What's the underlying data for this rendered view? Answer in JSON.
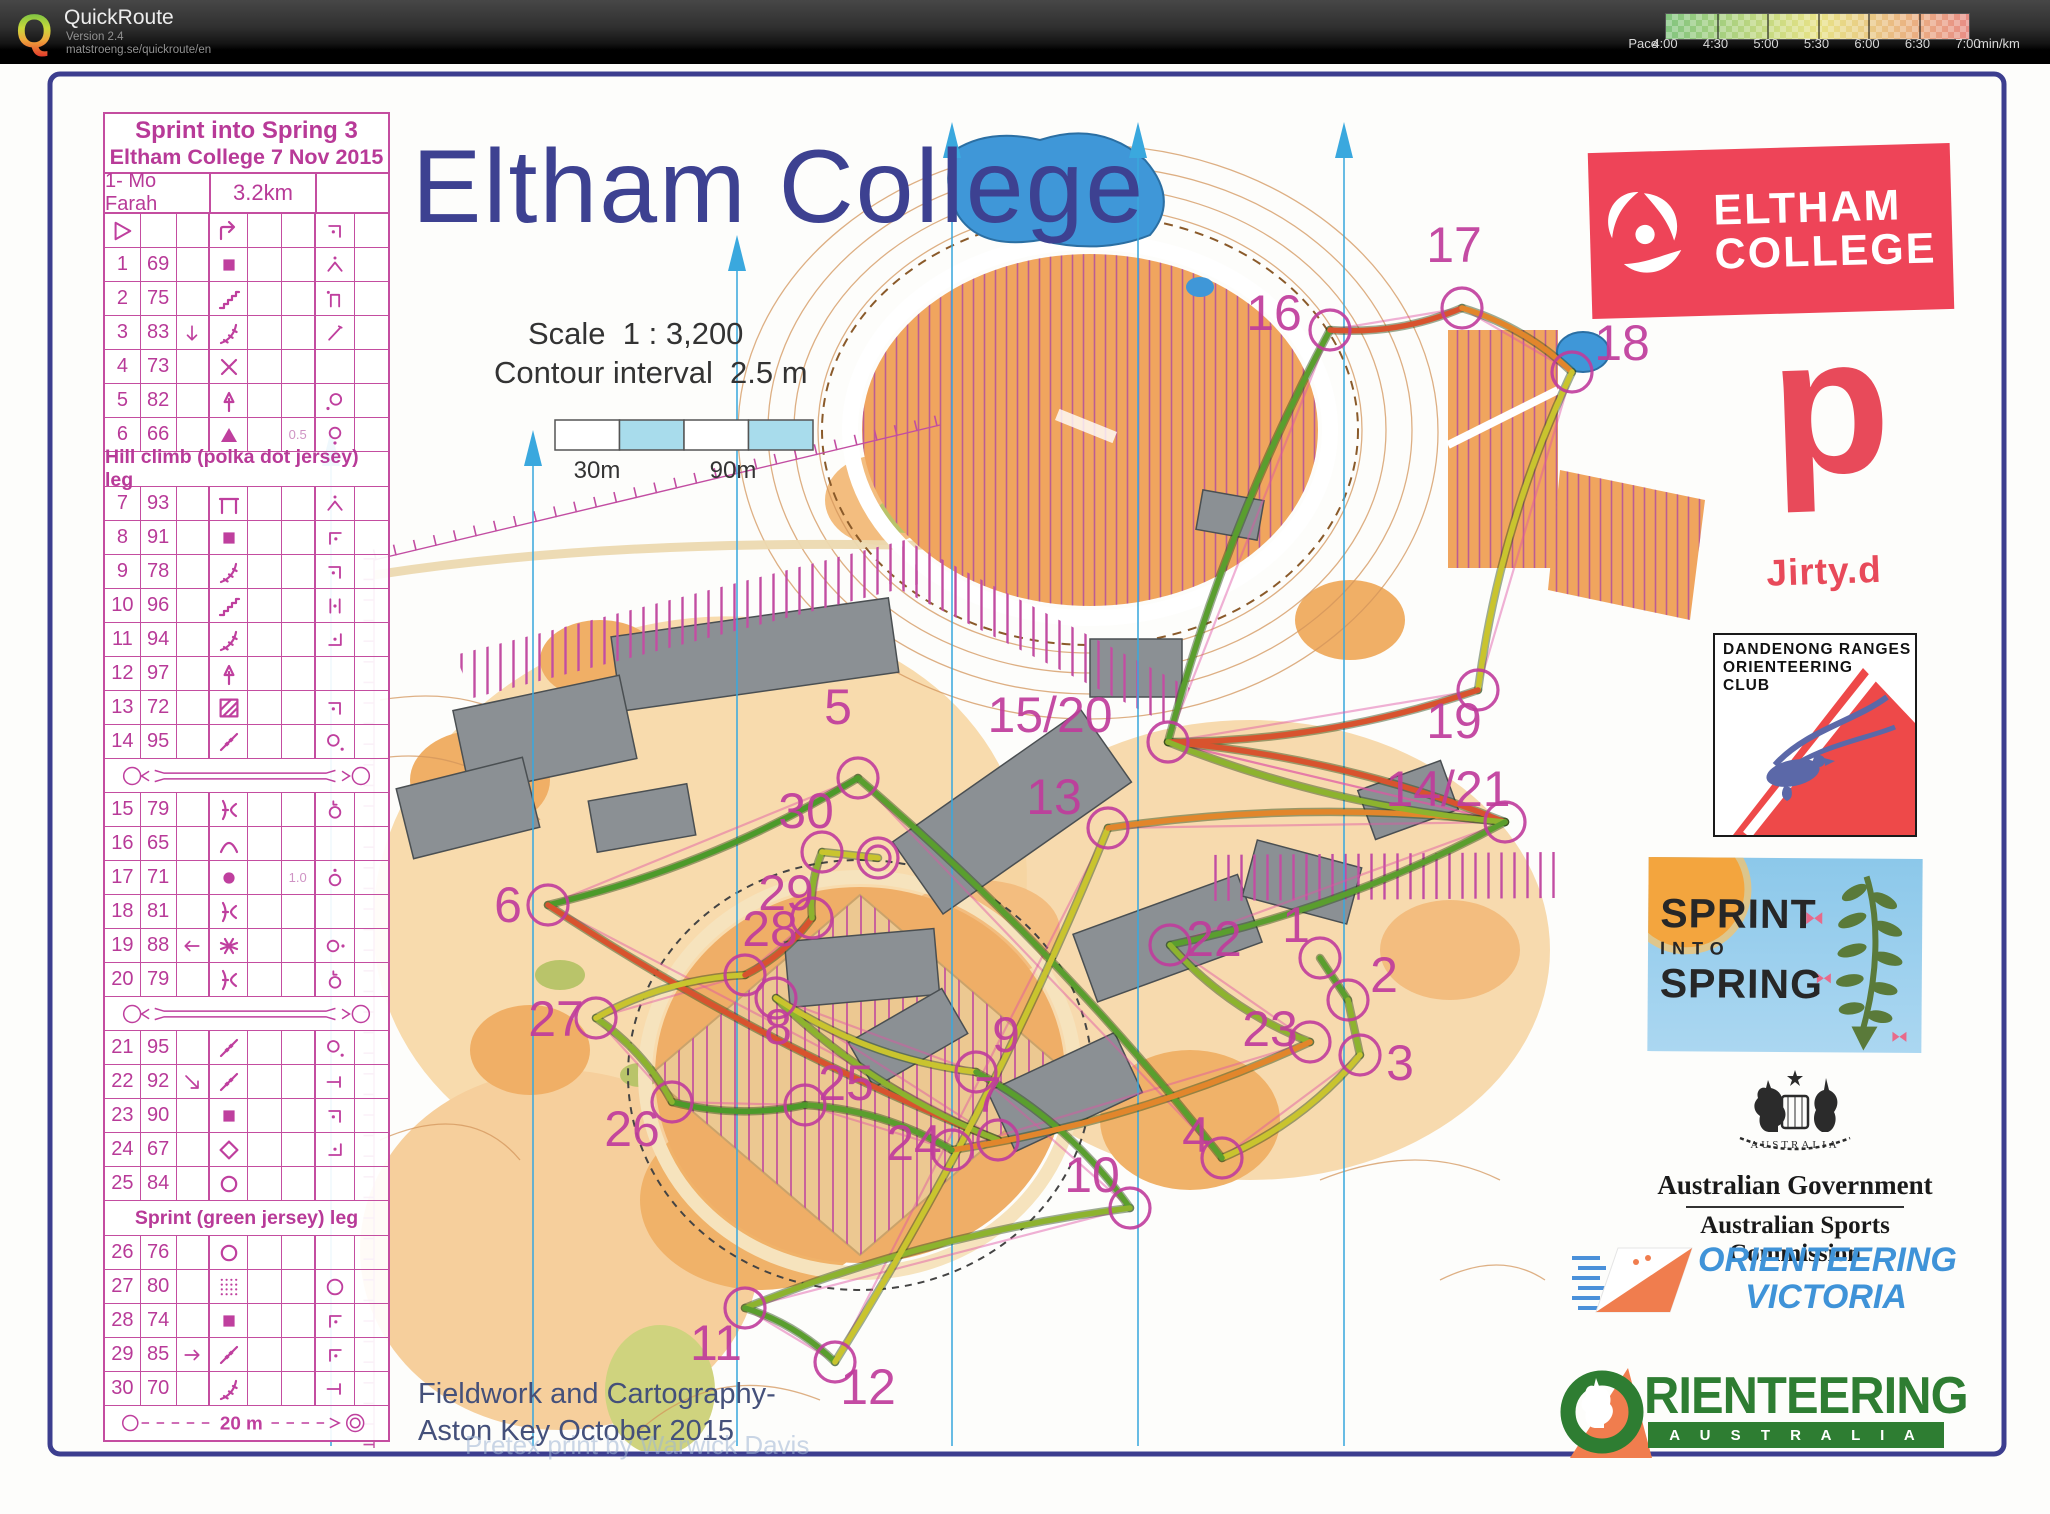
{
  "header": {
    "app_title": "QuickRoute",
    "version": "Version 2.4",
    "url": "matstroeng.se/quickroute/en",
    "legend": {
      "label": "Pace",
      "ticks": [
        "4:00",
        "4:30",
        "5:00",
        "5:30",
        "6:00",
        "6:30",
        "7:00"
      ],
      "unit": "min/km",
      "colors": [
        "#83c57f",
        "#a5cf7f",
        "#cbdb82",
        "#e7e287",
        "#e9cf85",
        "#eaaf82",
        "#e88d85"
      ]
    }
  },
  "map": {
    "title": "Eltham College",
    "scale_text": "Scale  1 : 3,200",
    "contour_text": "Contour interval  2.5 m",
    "scalebar_labels": [
      "30m",
      "90m"
    ],
    "credits": "Fieldwork and Cartography-\nAston Key October 2015",
    "watermark": "Pretex print by Warwick Davis",
    "magenta": "#c03c9c",
    "controls": [
      {
        "label": "1",
        "cx": 1320,
        "cy": 958,
        "tx": 1296,
        "ty": 942
      },
      {
        "label": "2",
        "cx": 1348,
        "cy": 1000,
        "tx": 1384,
        "ty": 992
      },
      {
        "label": "3",
        "cx": 1360,
        "cy": 1055,
        "tx": 1400,
        "ty": 1080
      },
      {
        "label": "4",
        "cx": 1222,
        "cy": 1158,
        "tx": 1196,
        "ty": 1152
      },
      {
        "label": "5",
        "cx": 858,
        "cy": 778,
        "tx": 838,
        "ty": 724
      },
      {
        "label": "6",
        "cx": 548,
        "cy": 905,
        "tx": 508,
        "ty": 922
      },
      {
        "label": "7",
        "cx": 998,
        "cy": 1140,
        "tx": 988,
        "ty": 1112
      },
      {
        "label": "8",
        "cx": 776,
        "cy": 998,
        "tx": 778,
        "ty": 1044
      },
      {
        "label": "9",
        "cx": 976,
        "cy": 1072,
        "tx": 1006,
        "ty": 1052
      },
      {
        "label": "10",
        "cx": 1130,
        "cy": 1208,
        "tx": 1092,
        "ty": 1192
      },
      {
        "label": "11",
        "cx": 745,
        "cy": 1308,
        "tx": 716,
        "ty": 1360
      },
      {
        "label": "12",
        "cx": 835,
        "cy": 1362,
        "tx": 868,
        "ty": 1404
      },
      {
        "label": "13",
        "cx": 1108,
        "cy": 828,
        "tx": 1054,
        "ty": 814
      },
      {
        "label": "14/21",
        "cx": 1505,
        "cy": 822,
        "tx": 1448,
        "ty": 806
      },
      {
        "label": "15/20",
        "cx": 1168,
        "cy": 742,
        "tx": 1050,
        "ty": 732
      },
      {
        "label": "16",
        "cx": 1330,
        "cy": 330,
        "tx": 1274,
        "ty": 330
      },
      {
        "label": "17",
        "cx": 1462,
        "cy": 308,
        "tx": 1454,
        "ty": 262
      },
      {
        "label": "18",
        "cx": 1572,
        "cy": 372,
        "tx": 1622,
        "ty": 360
      },
      {
        "label": "19",
        "cx": 1478,
        "cy": 690,
        "tx": 1454,
        "ty": 738
      },
      {
        "label": "22",
        "cx": 1170,
        "cy": 945,
        "tx": 1214,
        "ty": 956
      },
      {
        "label": "23",
        "cx": 1310,
        "cy": 1042,
        "tx": 1270,
        "ty": 1046
      },
      {
        "label": "24",
        "cx": 952,
        "cy": 1150,
        "tx": 914,
        "ty": 1160
      },
      {
        "label": "25",
        "cx": 805,
        "cy": 1105,
        "tx": 846,
        "ty": 1100
      },
      {
        "label": "26",
        "cx": 672,
        "cy": 1102,
        "tx": 632,
        "ty": 1146
      },
      {
        "label": "27",
        "cx": 596,
        "cy": 1018,
        "tx": 556,
        "ty": 1036
      },
      {
        "label": "28",
        "cx": 745,
        "cy": 975,
        "tx": 770,
        "ty": 946
      },
      {
        "label": "29",
        "cx": 812,
        "cy": 918,
        "tx": 786,
        "ty": 910
      },
      {
        "label": "30",
        "cx": 822,
        "cy": 852,
        "tx": 806,
        "ty": 828
      }
    ],
    "finish": {
      "cx": 878,
      "cy": 858
    },
    "sequence": [
      "1",
      "2",
      "3",
      "4",
      "5",
      "6",
      "7",
      "8",
      "9",
      "10",
      "11",
      "12",
      "13",
      "14/21",
      "15/20",
      "16",
      "17",
      "18",
      "19",
      "15/20",
      "14/21",
      "22",
      "23",
      "24",
      "25",
      "26",
      "27",
      "28",
      "29",
      "30",
      "F"
    ],
    "route_leg_colors": [
      "#5a9e2e",
      "#8db32e",
      "#c9c42e",
      "#5a9e2e",
      "#4c9a2a",
      "#d8532e",
      "#8db32e",
      "#c9c42e",
      "#5a9e2e",
      "#8db32e",
      "#5a9e2e",
      "#c9c42e",
      "#e2862b",
      "#d8532e",
      "#5a9e2e",
      "#d8532e",
      "#e2862b",
      "#c9c42e",
      "#d8532e",
      "#8db32e",
      "#5a9e2e",
      "#8db32e",
      "#e2862b",
      "#5a9e2e",
      "#4c9a2a",
      "#8db32e",
      "#c9c42e",
      "#d8532e",
      "#8db32e",
      "#c9c42e"
    ]
  },
  "control_sheet": {
    "title1": "Sprint into Spring 3",
    "title2": "Eltham College 7 Nov 2015",
    "class_name": "1- Mo Farah",
    "distance": "3.2km",
    "finish_distance": "20 m",
    "rows": [
      {
        "type": "start",
        "f": "bend",
        "g": "corner_ne"
      },
      {
        "type": "c",
        "n": "1",
        "code": "69",
        "f": "building",
        "g": "apexdot"
      },
      {
        "type": "c",
        "n": "2",
        "code": "75",
        "f": "steps",
        "g": "udot"
      },
      {
        "type": "c",
        "n": "3",
        "code": "83",
        "c": "arrow_down",
        "f": "steps2",
        "g": "diag"
      },
      {
        "type": "c",
        "n": "4",
        "code": "73",
        "f": "cross"
      },
      {
        "type": "c",
        "n": "5",
        "code": "82",
        "f": "tree",
        "g": "c_sw"
      },
      {
        "type": "c",
        "n": "6",
        "code": "66",
        "f": "boulder",
        "dim": "0.5",
        "g": "c_s"
      },
      {
        "type": "leg",
        "text": "Hill climb (polka dot jersey) leg"
      },
      {
        "type": "c",
        "n": "7",
        "code": "93",
        "f": "canopy",
        "g": "apexdot"
      },
      {
        "type": "c",
        "n": "8",
        "code": "91",
        "f": "building",
        "g": "corner_nw"
      },
      {
        "type": "c",
        "n": "9",
        "code": "78",
        "f": "steps2",
        "g": "corner_ne"
      },
      {
        "type": "c",
        "n": "10",
        "code": "96",
        "f": "steps",
        "g": "between"
      },
      {
        "type": "c",
        "n": "11",
        "code": "94",
        "f": "steps2",
        "g": "corner_se"
      },
      {
        "type": "c",
        "n": "12",
        "code": "97",
        "f": "tree"
      },
      {
        "type": "c",
        "n": "13",
        "code": "72",
        "f": "hatched",
        "g": "corner_ne"
      },
      {
        "type": "c",
        "n": "14",
        "code": "95",
        "f": "fencecross",
        "g": "c_se"
      },
      {
        "type": "sep"
      },
      {
        "type": "c",
        "n": "15",
        "code": "79",
        "f": "fencecorner",
        "g": "c_L"
      },
      {
        "type": "c",
        "n": "16",
        "code": "65",
        "f": "hill"
      },
      {
        "type": "c",
        "n": "17",
        "code": "71",
        "f": "dot",
        "dim": "1.0",
        "g": "c_n"
      },
      {
        "type": "c",
        "n": "18",
        "code": "81",
        "f": "fencecorner"
      },
      {
        "type": "c",
        "n": "19",
        "code": "88",
        "c": "arrow_left",
        "f": "lattice",
        "g": "c_e"
      },
      {
        "type": "c",
        "n": "20",
        "code": "79",
        "f": "fencecorner",
        "g": "c_L"
      },
      {
        "type": "sep"
      },
      {
        "type": "c",
        "n": "21",
        "code": "95",
        "f": "fencecross",
        "g": "c_se"
      },
      {
        "type": "c",
        "n": "22",
        "code": "92",
        "c": "arrow_se",
        "f": "fencecross",
        "g": "wallend"
      },
      {
        "type": "c",
        "n": "23",
        "code": "90",
        "f": "building",
        "g": "corner_ne"
      },
      {
        "type": "c",
        "n": "24",
        "code": "67",
        "f": "diamond",
        "g": "corner_se"
      },
      {
        "type": "c",
        "n": "25",
        "code": "84",
        "f": "circle"
      },
      {
        "type": "leg",
        "text": "Sprint (green jersey) leg"
      },
      {
        "type": "c",
        "n": "26",
        "code": "76",
        "f": "circle"
      },
      {
        "type": "c",
        "n": "27",
        "code": "80",
        "f": "dotted",
        "g": "bigcircle"
      },
      {
        "type": "c",
        "n": "28",
        "code": "74",
        "f": "building",
        "g": "corner_nw"
      },
      {
        "type": "c",
        "n": "29",
        "code": "85",
        "c": "arrow_right",
        "f": "fencecross",
        "g": "corner_nw"
      },
      {
        "type": "c",
        "n": "30",
        "code": "70",
        "f": "steps2",
        "g": "wallend"
      },
      {
        "type": "finish"
      }
    ]
  },
  "logos": {
    "eltham": {
      "line1": "ELTHAM",
      "line2": "COLLEGE",
      "color": "#ee4458"
    },
    "dirty": {
      "big_letter": "d",
      "text": "Jirty.d",
      "color": "#e84a5a"
    },
    "droc": {
      "lines": [
        "DANDENONG RANGES",
        "ORIENTEERING",
        "CLUB"
      ]
    },
    "sprint_into_spring": {
      "line1": "SPRINT",
      "line2": "INTO",
      "line3": "SPRING"
    },
    "ausgov": {
      "title": "Australian Government",
      "subtitle": "Australian Sports Commission",
      "crest_text": "AUSTRALIA"
    },
    "ov": {
      "line1": "ORIENTEERING",
      "line2": "VICTORIA"
    },
    "oa": {
      "word": "RIENTEERING",
      "band": "A U S T R A L I A"
    }
  }
}
